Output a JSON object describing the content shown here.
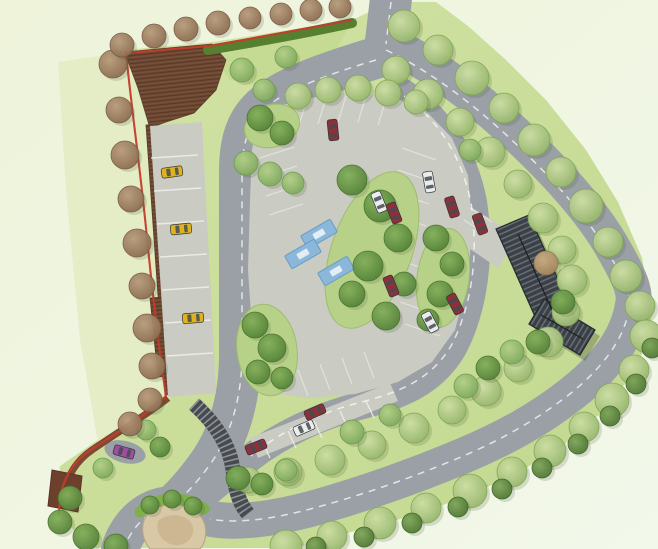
{
  "canvas": {
    "width": 658,
    "height": 549
  },
  "palette": {
    "bg_top_left": "#eef3da",
    "bg_bottom_right": "#f2f8ea",
    "site_lawn_light": "#d3e3a6",
    "site_lawn_dark": "#c1d88e",
    "left_lawn": "#e2ecc3",
    "wedge_lawn": "#c5db93",
    "island_green": "#b7d288",
    "road": "#9aa0a6",
    "road_marking": "#ffffff",
    "court_paving": "#cacbc2",
    "bay_line": "#f2f2ee",
    "woodland_brown": "#6f4a33",
    "woodland_hatch": "#583828",
    "boundary_red": "#c53b2c",
    "hedge_green": "#567f2f",
    "wall_brown": "#7b4b33",
    "wall_block": "#6d3f2d",
    "roof_dark": "#3b4046",
    "roof_stripe": "#6b727b",
    "steps_dark": "#474b50",
    "steps_tread": "#9aa0a4",
    "sand": "#d9c8a5",
    "sand_inner": "#c9b48e",
    "bush_bright": "#7fae4a",
    "blue_bay": "#8ab7da",
    "blue_bay_edge": "#6b9cc4",
    "car_yellow": "#dfb31f",
    "car_red": "#8e3038",
    "car_white": "#ebedec",
    "car_purple": "#9c4f9e",
    "car_window": "#454a52",
    "tree_light_hi": "#cfe0a6",
    "tree_light_lo": "#93b469",
    "tree_med_hi": "#b3d189",
    "tree_med_lo": "#7ca75a",
    "tree_dark_hi": "#84b15c",
    "tree_dark_lo": "#527f36",
    "tree_brown_hi": "#b99c7d",
    "tree_brown_lo": "#8a6a4e",
    "tree_tan_hi": "#cdb083",
    "tree_tan_lo": "#a3835c",
    "tree_scallop_hi": "#7fa65a",
    "tree_scallop_lo": "#4c7531"
  },
  "site_outline": [
    [
      123,
      50
    ],
    [
      213,
      42
    ],
    [
      352,
      20
    ],
    [
      390,
      2
    ],
    [
      436,
      2
    ],
    [
      468,
      26
    ],
    [
      506,
      60
    ],
    [
      546,
      100
    ],
    [
      586,
      150
    ],
    [
      618,
      202
    ],
    [
      642,
      258
    ],
    [
      652,
      312
    ],
    [
      648,
      342
    ],
    [
      630,
      378
    ],
    [
      600,
      414
    ],
    [
      560,
      448
    ],
    [
      512,
      476
    ],
    [
      458,
      500
    ],
    [
      400,
      519
    ],
    [
      340,
      535
    ],
    [
      296,
      548
    ],
    [
      92,
      548
    ],
    [
      70,
      526
    ],
    [
      56,
      498
    ],
    [
      60,
      466
    ],
    [
      92,
      444
    ],
    [
      132,
      417
    ],
    [
      163,
      396
    ],
    [
      152,
      296
    ],
    [
      140,
      168
    ],
    [
      128,
      88
    ]
  ],
  "lawns": {
    "left_strip": [
      [
        58,
        62
      ],
      [
        126,
        52
      ],
      [
        150,
        130
      ],
      [
        168,
        300
      ],
      [
        172,
        396
      ],
      [
        138,
        420
      ],
      [
        98,
        442
      ],
      [
        80,
        340
      ],
      [
        66,
        190
      ]
    ],
    "north_wedge": [
      [
        212,
        56
      ],
      [
        348,
        28
      ],
      [
        330,
        62
      ],
      [
        268,
        88
      ],
      [
        230,
        80
      ]
    ]
  },
  "woodland": {
    "top_block": [
      [
        124,
        52
      ],
      [
        212,
        44
      ],
      [
        226,
        60
      ],
      [
        216,
        90
      ],
      [
        194,
        113
      ],
      [
        166,
        122
      ],
      [
        150,
        128
      ],
      [
        138,
        88
      ],
      [
        129,
        64
      ]
    ],
    "west_strip": [
      [
        146,
        125
      ],
      [
        158,
        124
      ],
      [
        176,
        393
      ],
      [
        165,
        395
      ]
    ],
    "mid_patch": [
      [
        150,
        298
      ],
      [
        176,
        296
      ],
      [
        182,
        374
      ],
      [
        158,
        377
      ]
    ]
  },
  "roads": [
    {
      "name": "entrance-road",
      "d": "M392,-10 L385,50",
      "w": 42
    },
    {
      "name": "avenue-road",
      "d": "M390,44 C436,66 480,100 520,138 C558,174 594,214 614,250 C630,278 636,292 633,305 C628,338 605,368 570,395 C538,420 505,438 465,455 C420,474 370,492 318,507 C278,518 240,524 212,519 C196,516 184,512 174,505",
      "w": 36
    },
    {
      "name": "west-loop-road",
      "d": "M382,56 C336,70 292,84 266,104 C246,120 240,142 240,172 L240,355 C240,396 230,436 207,467 C196,482 186,494 174,505",
      "w": 42
    },
    {
      "name": "bottom-exit-road",
      "d": "M174,505 C150,505 130,520 120,549",
      "w": 38
    },
    {
      "name": "ring-road-east",
      "d": "M402,92 C440,118 464,156 473,202 C481,254 474,308 453,348 C432,384 398,396 359,406 C320,416 281,434 250,458 C232,472 213,488 198,500",
      "w": 28
    }
  ],
  "markings": [
    {
      "name": "entrance-centerline",
      "d": "M391,2 L386,44"
    },
    {
      "name": "avenue-centerline",
      "d": "M386,50 C432,72 476,106 516,144 C554,180 590,220 610,256 C626,282 632,296 629,309 C624,340 601,370 566,397 C534,421 501,440 461,457 C416,476 366,494 314,508 C274,519 237,524 210,519"
    },
    {
      "name": "west-loop-centerline",
      "d": "M376,60 C332,73 290,88 266,107 C248,123 242,145 242,174 L242,354 C242,395 232,434 209,466 C198,481 187,493 175,504"
    },
    {
      "name": "exit-centerline",
      "d": "M174,505 C152,509 134,522 124,548"
    },
    {
      "name": "ring-centerline",
      "d": "M404,96 C440,121 462,158 471,203 C479,254 472,306 451,346 C430,381 397,393 358,403 C319,413 281,431 251,456"
    }
  ],
  "paving": {
    "court": [
      [
        258,
        112
      ],
      [
        300,
        100
      ],
      [
        345,
        92
      ],
      [
        390,
        96
      ],
      [
        425,
        110
      ],
      [
        452,
        138
      ],
      [
        468,
        175
      ],
      [
        472,
        225
      ],
      [
        468,
        280
      ],
      [
        455,
        330
      ],
      [
        432,
        362
      ],
      [
        398,
        382
      ],
      [
        355,
        394
      ],
      [
        310,
        398
      ],
      [
        278,
        394
      ],
      [
        262,
        375
      ],
      [
        252,
        330
      ],
      [
        248,
        270
      ],
      [
        250,
        200
      ],
      [
        252,
        150
      ]
    ],
    "west_strip": [
      [
        150,
        126
      ],
      [
        202,
        122
      ],
      [
        216,
        393
      ],
      [
        168,
        397
      ]
    ],
    "south_strip": [
      [
        250,
        438
      ],
      [
        390,
        383
      ],
      [
        398,
        401
      ],
      [
        258,
        458
      ]
    ],
    "building_apron": [
      [
        456,
        198
      ],
      [
        518,
        236
      ],
      [
        498,
        268
      ],
      [
        442,
        230
      ]
    ],
    "layby": {
      "cx": 125,
      "cy": 452,
      "rx": 21,
      "ry": 11,
      "rot": 14
    }
  },
  "bay_lines": [
    [
      260,
      158,
      294,
      147
    ],
    [
      263,
      177,
      297,
      166
    ],
    [
      266,
      196,
      300,
      185
    ],
    [
      269,
      215,
      303,
      204
    ],
    [
      402,
      148,
      436,
      160
    ],
    [
      398,
      170,
      433,
      182
    ],
    [
      394,
      192,
      429,
      204
    ],
    [
      391,
      214,
      426,
      226
    ],
    [
      393,
      258,
      428,
      270
    ],
    [
      396,
      280,
      431,
      292
    ],
    [
      400,
      302,
      435,
      314
    ],
    [
      405,
      324,
      440,
      336
    ],
    [
      298,
      370,
      308,
      396
    ],
    [
      320,
      364,
      330,
      390
    ],
    [
      342,
      358,
      352,
      384
    ],
    [
      364,
      352,
      374,
      378
    ],
    [
      306,
      102,
      298,
      128
    ],
    [
      326,
      98,
      318,
      124
    ],
    [
      346,
      96,
      338,
      122
    ],
    [
      366,
      96,
      358,
      122
    ],
    [
      386,
      99,
      378,
      125
    ],
    [
      470,
      208,
      492,
      222
    ],
    [
      464,
      220,
      486,
      234
    ]
  ],
  "strip_dividers": [
    [
      151,
      158,
      198,
      155
    ],
    [
      154,
      191,
      201,
      188
    ],
    [
      157,
      224,
      204,
      221
    ],
    [
      160,
      257,
      207,
      254
    ],
    [
      162,
      290,
      209,
      287
    ],
    [
      165,
      323,
      211,
      320
    ],
    [
      167,
      356,
      213,
      353
    ],
    [
      262,
      441,
      270,
      458
    ],
    [
      288,
      431,
      296,
      448
    ],
    [
      314,
      421,
      322,
      438
    ],
    [
      340,
      411,
      348,
      428
    ],
    [
      366,
      401,
      374,
      418
    ]
  ],
  "islands": [
    {
      "name": "island-top-left",
      "cx": 272,
      "cy": 126,
      "rx": 28,
      "ry": 21,
      "rot": -18
    },
    {
      "name": "island-central",
      "cx": 372,
      "cy": 250,
      "rx": 40,
      "ry": 82,
      "rot": 20
    },
    {
      "name": "island-east",
      "cx": 443,
      "cy": 278,
      "rx": 26,
      "ry": 50,
      "rot": 8
    },
    {
      "name": "island-west",
      "cx": 267,
      "cy": 350,
      "rx": 30,
      "ry": 46,
      "rot": -8
    }
  ],
  "blue_bays": {
    "w": 34,
    "h": 15,
    "items": [
      [
        319,
        234,
        -30
      ],
      [
        303,
        254,
        -30
      ],
      [
        336,
        271,
        -30
      ]
    ]
  },
  "steps": {
    "d": "M194,404 C216,424 230,446 233,470 C236,494 240,504 248,514",
    "w": 15
  },
  "building": {
    "wing_a": [
      [
        496,
        229
      ],
      [
        529,
        215
      ],
      [
        574,
        315
      ],
      [
        541,
        330
      ]
    ],
    "wing_b": [
      [
        529,
        324
      ],
      [
        544,
        299
      ],
      [
        595,
        330
      ],
      [
        580,
        355
      ]
    ],
    "ridge_a": [
      518,
      234,
      552,
      310
    ],
    "ridge_b": [
      541,
      315,
      583,
      339
    ],
    "shadow_dx": 5,
    "shadow_dy": 6
  },
  "sand": {
    "outer": "M148,514 C158,502 186,502 198,513 C208,523 208,540 200,549 L150,549 C141,538 140,523 148,514 Z",
    "inner": "M158,521 C168,512 186,514 192,524 C196,533 190,543 180,545 C168,547 154,536 158,521 Z",
    "bush_arc": "M140,512 C156,496 186,494 204,509"
  },
  "walls": {
    "curved_wall": "M168,398 C148,414 118,432 92,450 C76,461 67,476 64,494",
    "block": [
      [
        52,
        470
      ],
      [
        82,
        476
      ],
      [
        78,
        512
      ],
      [
        48,
        506
      ]
    ]
  },
  "boundary": {
    "d": "M352,20 L210,46 L126,53 C132,112 141,175 147,238 C152,288 158,342 166,396 C150,412 122,430 92,449 C74,460 64,477 60,497 L59,514"
  },
  "hedge": {
    "d": "M208,50 C256,42 306,33 352,23",
    "w": 10
  },
  "trees": {
    "light": [
      [
        404,
        26,
        16
      ],
      [
        438,
        50,
        15
      ],
      [
        472,
        78,
        17
      ],
      [
        504,
        108,
        15
      ],
      [
        534,
        140,
        16
      ],
      [
        561,
        172,
        15
      ],
      [
        586,
        206,
        17
      ],
      [
        608,
        242,
        15
      ],
      [
        626,
        276,
        16
      ],
      [
        640,
        306,
        15
      ],
      [
        646,
        336,
        16
      ],
      [
        634,
        370,
        15
      ],
      [
        612,
        400,
        17
      ],
      [
        584,
        427,
        15
      ],
      [
        550,
        451,
        16
      ],
      [
        512,
        472,
        15
      ],
      [
        470,
        491,
        17
      ],
      [
        426,
        508,
        15
      ],
      [
        380,
        523,
        16
      ],
      [
        332,
        536,
        15
      ],
      [
        286,
        546,
        16
      ],
      [
        396,
        70,
        14
      ],
      [
        428,
        94,
        15
      ],
      [
        460,
        122,
        14
      ],
      [
        490,
        152,
        15
      ],
      [
        518,
        184,
        14
      ],
      [
        543,
        218,
        15
      ],
      [
        562,
        250,
        14
      ],
      [
        572,
        280,
        15
      ],
      [
        566,
        312,
        14
      ],
      [
        548,
        342,
        15
      ],
      [
        518,
        368,
        14
      ],
      [
        486,
        391,
        15
      ],
      [
        452,
        410,
        14
      ],
      [
        414,
        428,
        15
      ],
      [
        372,
        445,
        14
      ],
      [
        330,
        460,
        15
      ],
      [
        288,
        472,
        14
      ],
      [
        248,
        480,
        13
      ],
      [
        298,
        96,
        13
      ],
      [
        328,
        90,
        13
      ],
      [
        358,
        88,
        13
      ],
      [
        388,
        93,
        13
      ],
      [
        416,
        102,
        12
      ]
    ],
    "med": [
      [
        242,
        70,
        12
      ],
      [
        264,
        90,
        11
      ],
      [
        286,
        57,
        11
      ],
      [
        246,
        163,
        12
      ],
      [
        270,
        174,
        12
      ],
      [
        293,
        183,
        11
      ],
      [
        352,
        432,
        12
      ],
      [
        390,
        415,
        11
      ],
      [
        286,
        470,
        11
      ],
      [
        146,
        430,
        10
      ],
      [
        103,
        468,
        10
      ],
      [
        466,
        386,
        12
      ],
      [
        512,
        352,
        12
      ],
      [
        470,
        150,
        11
      ]
    ],
    "dark": [
      [
        260,
        118,
        13
      ],
      [
        282,
        133,
        12
      ],
      [
        352,
        180,
        15
      ],
      [
        380,
        206,
        16
      ],
      [
        398,
        238,
        14
      ],
      [
        368,
        266,
        15
      ],
      [
        352,
        294,
        13
      ],
      [
        386,
        316,
        14
      ],
      [
        404,
        284,
        12
      ],
      [
        436,
        238,
        13
      ],
      [
        452,
        264,
        12
      ],
      [
        440,
        294,
        13
      ],
      [
        428,
        320,
        11
      ],
      [
        255,
        325,
        13
      ],
      [
        272,
        348,
        14
      ],
      [
        258,
        372,
        12
      ],
      [
        282,
        378,
        11
      ],
      [
        563,
        302,
        12
      ],
      [
        538,
        342,
        12
      ],
      [
        488,
        368,
        12
      ],
      [
        238,
        478,
        12
      ],
      [
        262,
        484,
        11
      ],
      [
        70,
        498,
        12
      ],
      [
        60,
        522,
        12
      ],
      [
        86,
        537,
        13
      ],
      [
        116,
        546,
        12
      ],
      [
        160,
        447,
        10
      ],
      [
        150,
        505,
        9
      ],
      [
        172,
        499,
        9
      ],
      [
        193,
        506,
        9
      ]
    ],
    "brown": [
      [
        113,
        64,
        14
      ],
      [
        119,
        110,
        13
      ],
      [
        125,
        155,
        14
      ],
      [
        131,
        199,
        13
      ],
      [
        137,
        243,
        14
      ],
      [
        142,
        286,
        13
      ],
      [
        147,
        328,
        14
      ],
      [
        152,
        366,
        13
      ],
      [
        150,
        400,
        12
      ],
      [
        130,
        424,
        12
      ],
      [
        122,
        45,
        12
      ],
      [
        154,
        36,
        12
      ],
      [
        186,
        29,
        12
      ],
      [
        218,
        23,
        12
      ],
      [
        250,
        18,
        11
      ],
      [
        281,
        14,
        11
      ],
      [
        311,
        10,
        11
      ],
      [
        340,
        7,
        11
      ]
    ],
    "tan": [
      [
        546,
        263,
        12
      ]
    ],
    "scallop": [
      [
        652,
        348,
        10
      ],
      [
        636,
        384,
        10
      ],
      [
        610,
        416,
        10
      ],
      [
        578,
        444,
        10
      ],
      [
        542,
        468,
        10
      ],
      [
        502,
        489,
        10
      ],
      [
        458,
        507,
        10
      ],
      [
        412,
        523,
        10
      ],
      [
        364,
        537,
        10
      ],
      [
        316,
        547,
        10
      ]
    ]
  },
  "cars": [
    {
      "x": 172,
      "y": 172,
      "a": -8,
      "c": "car_yellow",
      "name": "parked-car-yellow"
    },
    {
      "x": 181,
      "y": 229,
      "a": -6,
      "c": "car_yellow",
      "name": "parked-car-yellow"
    },
    {
      "x": 193,
      "y": 318,
      "a": -5,
      "c": "car_yellow",
      "name": "parked-car-yellow"
    },
    {
      "x": 333,
      "y": 130,
      "a": 84,
      "c": "car_red",
      "name": "parked-car-red"
    },
    {
      "x": 379,
      "y": 202,
      "a": 68,
      "c": "car_white",
      "name": "parked-car-white"
    },
    {
      "x": 394,
      "y": 213,
      "a": 68,
      "c": "car_red",
      "name": "parked-car-red"
    },
    {
      "x": 429,
      "y": 182,
      "a": 80,
      "c": "car_white",
      "name": "parked-car-white"
    },
    {
      "x": 452,
      "y": 207,
      "a": 72,
      "c": "car_red",
      "name": "parked-car-red"
    },
    {
      "x": 480,
      "y": 224,
      "a": 70,
      "c": "car_red",
      "name": "parked-car-red"
    },
    {
      "x": 391,
      "y": 286,
      "a": 68,
      "c": "car_red",
      "name": "parked-car-red"
    },
    {
      "x": 455,
      "y": 304,
      "a": 62,
      "c": "car_red",
      "name": "parked-car-red"
    },
    {
      "x": 430,
      "y": 322,
      "a": 62,
      "c": "car_white",
      "name": "parked-car-white"
    },
    {
      "x": 315,
      "y": 412,
      "a": -24,
      "c": "car_red",
      "name": "parked-car-red"
    },
    {
      "x": 304,
      "y": 428,
      "a": -24,
      "c": "car_white",
      "name": "parked-car-white"
    },
    {
      "x": 256,
      "y": 447,
      "a": -22,
      "c": "car_red",
      "name": "parked-car-red"
    },
    {
      "x": 124,
      "y": 452,
      "a": 16,
      "c": "car_purple",
      "name": "parked-car-purple"
    }
  ]
}
